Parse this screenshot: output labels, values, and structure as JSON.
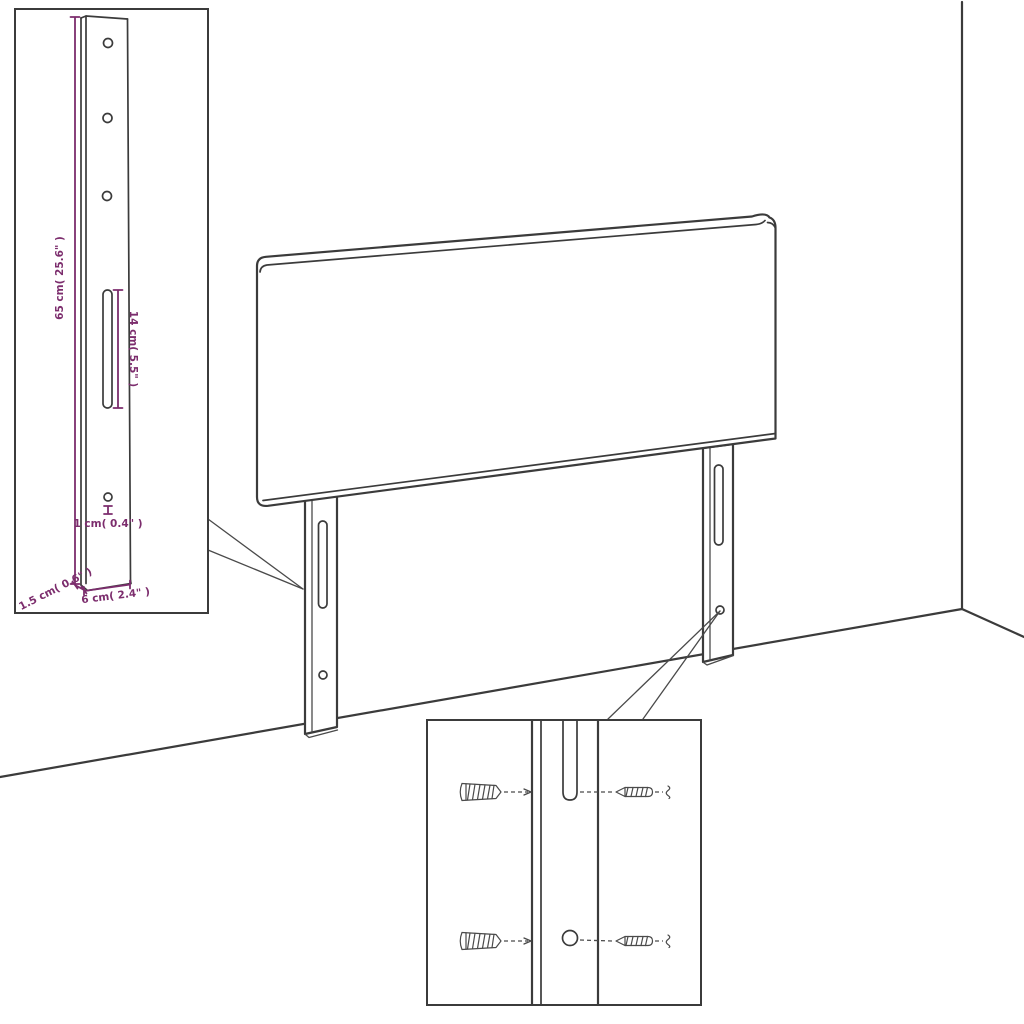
{
  "colors": {
    "line": "#3b3b3b",
    "dimension_accent": "#7c2d6d",
    "background": "#ffffff"
  },
  "dimensions": {
    "bracket_height": "65 cm( 25.6\" )",
    "slot_length": "14 cm( 5.5\" )",
    "hole_diameter": "1 cm( 0.4\" )",
    "bracket_depth": "1.5 cm( 0.6\" )",
    "bracket_width": "6 cm( 2.4\" )"
  }
}
